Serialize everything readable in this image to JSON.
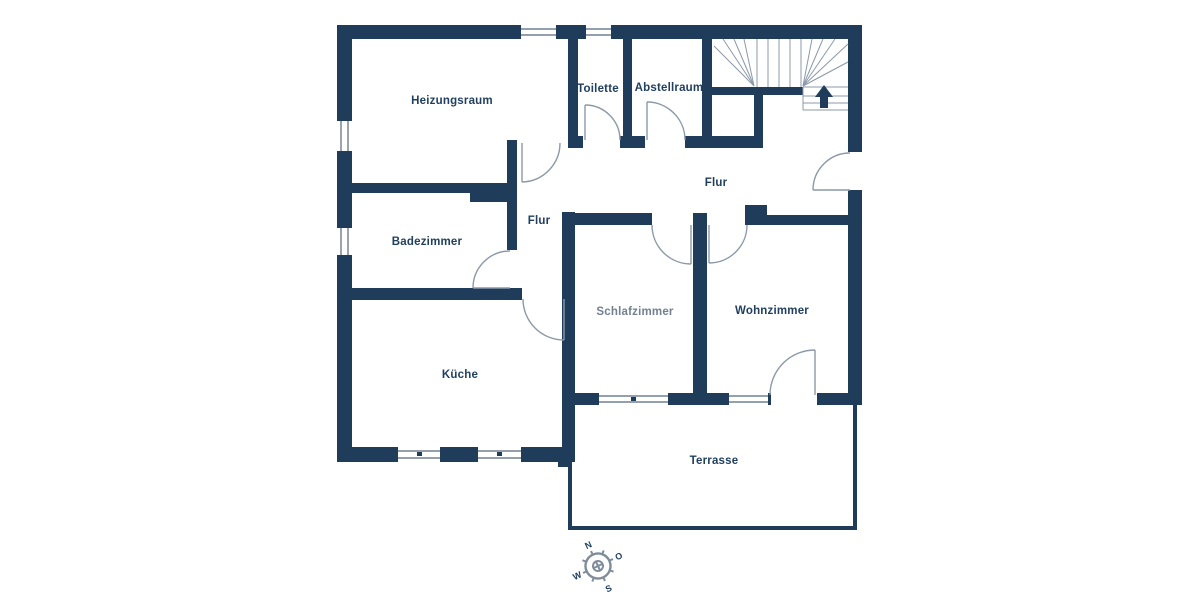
{
  "theme": {
    "wall": "#1f3d5a",
    "line": "#8b99a9",
    "winline": "#56677a",
    "text": "#21405f",
    "muted_text": "#72808f",
    "bg": "#ffffff",
    "compass": "#7e8c9b"
  },
  "plan": {
    "rooms": [
      {
        "id": "heizungsraum",
        "label": "Heizungsraum"
      },
      {
        "id": "toilette",
        "label": "Toilette"
      },
      {
        "id": "abstellraum",
        "label": "Abstellraum"
      },
      {
        "id": "flur-main",
        "label": "Flur"
      },
      {
        "id": "flur-small",
        "label": "Flur"
      },
      {
        "id": "badezimmer",
        "label": "Badezimmer"
      },
      {
        "id": "kueche",
        "label": "Küche"
      },
      {
        "id": "schlafzimmer",
        "label": "Schlafzimmer"
      },
      {
        "id": "wohnzimmer",
        "label": "Wohnzimmer"
      },
      {
        "id": "terrasse",
        "label": "Terrasse"
      }
    ],
    "compass": {
      "north": "N",
      "east": "O",
      "south": "S",
      "west": "W"
    }
  }
}
